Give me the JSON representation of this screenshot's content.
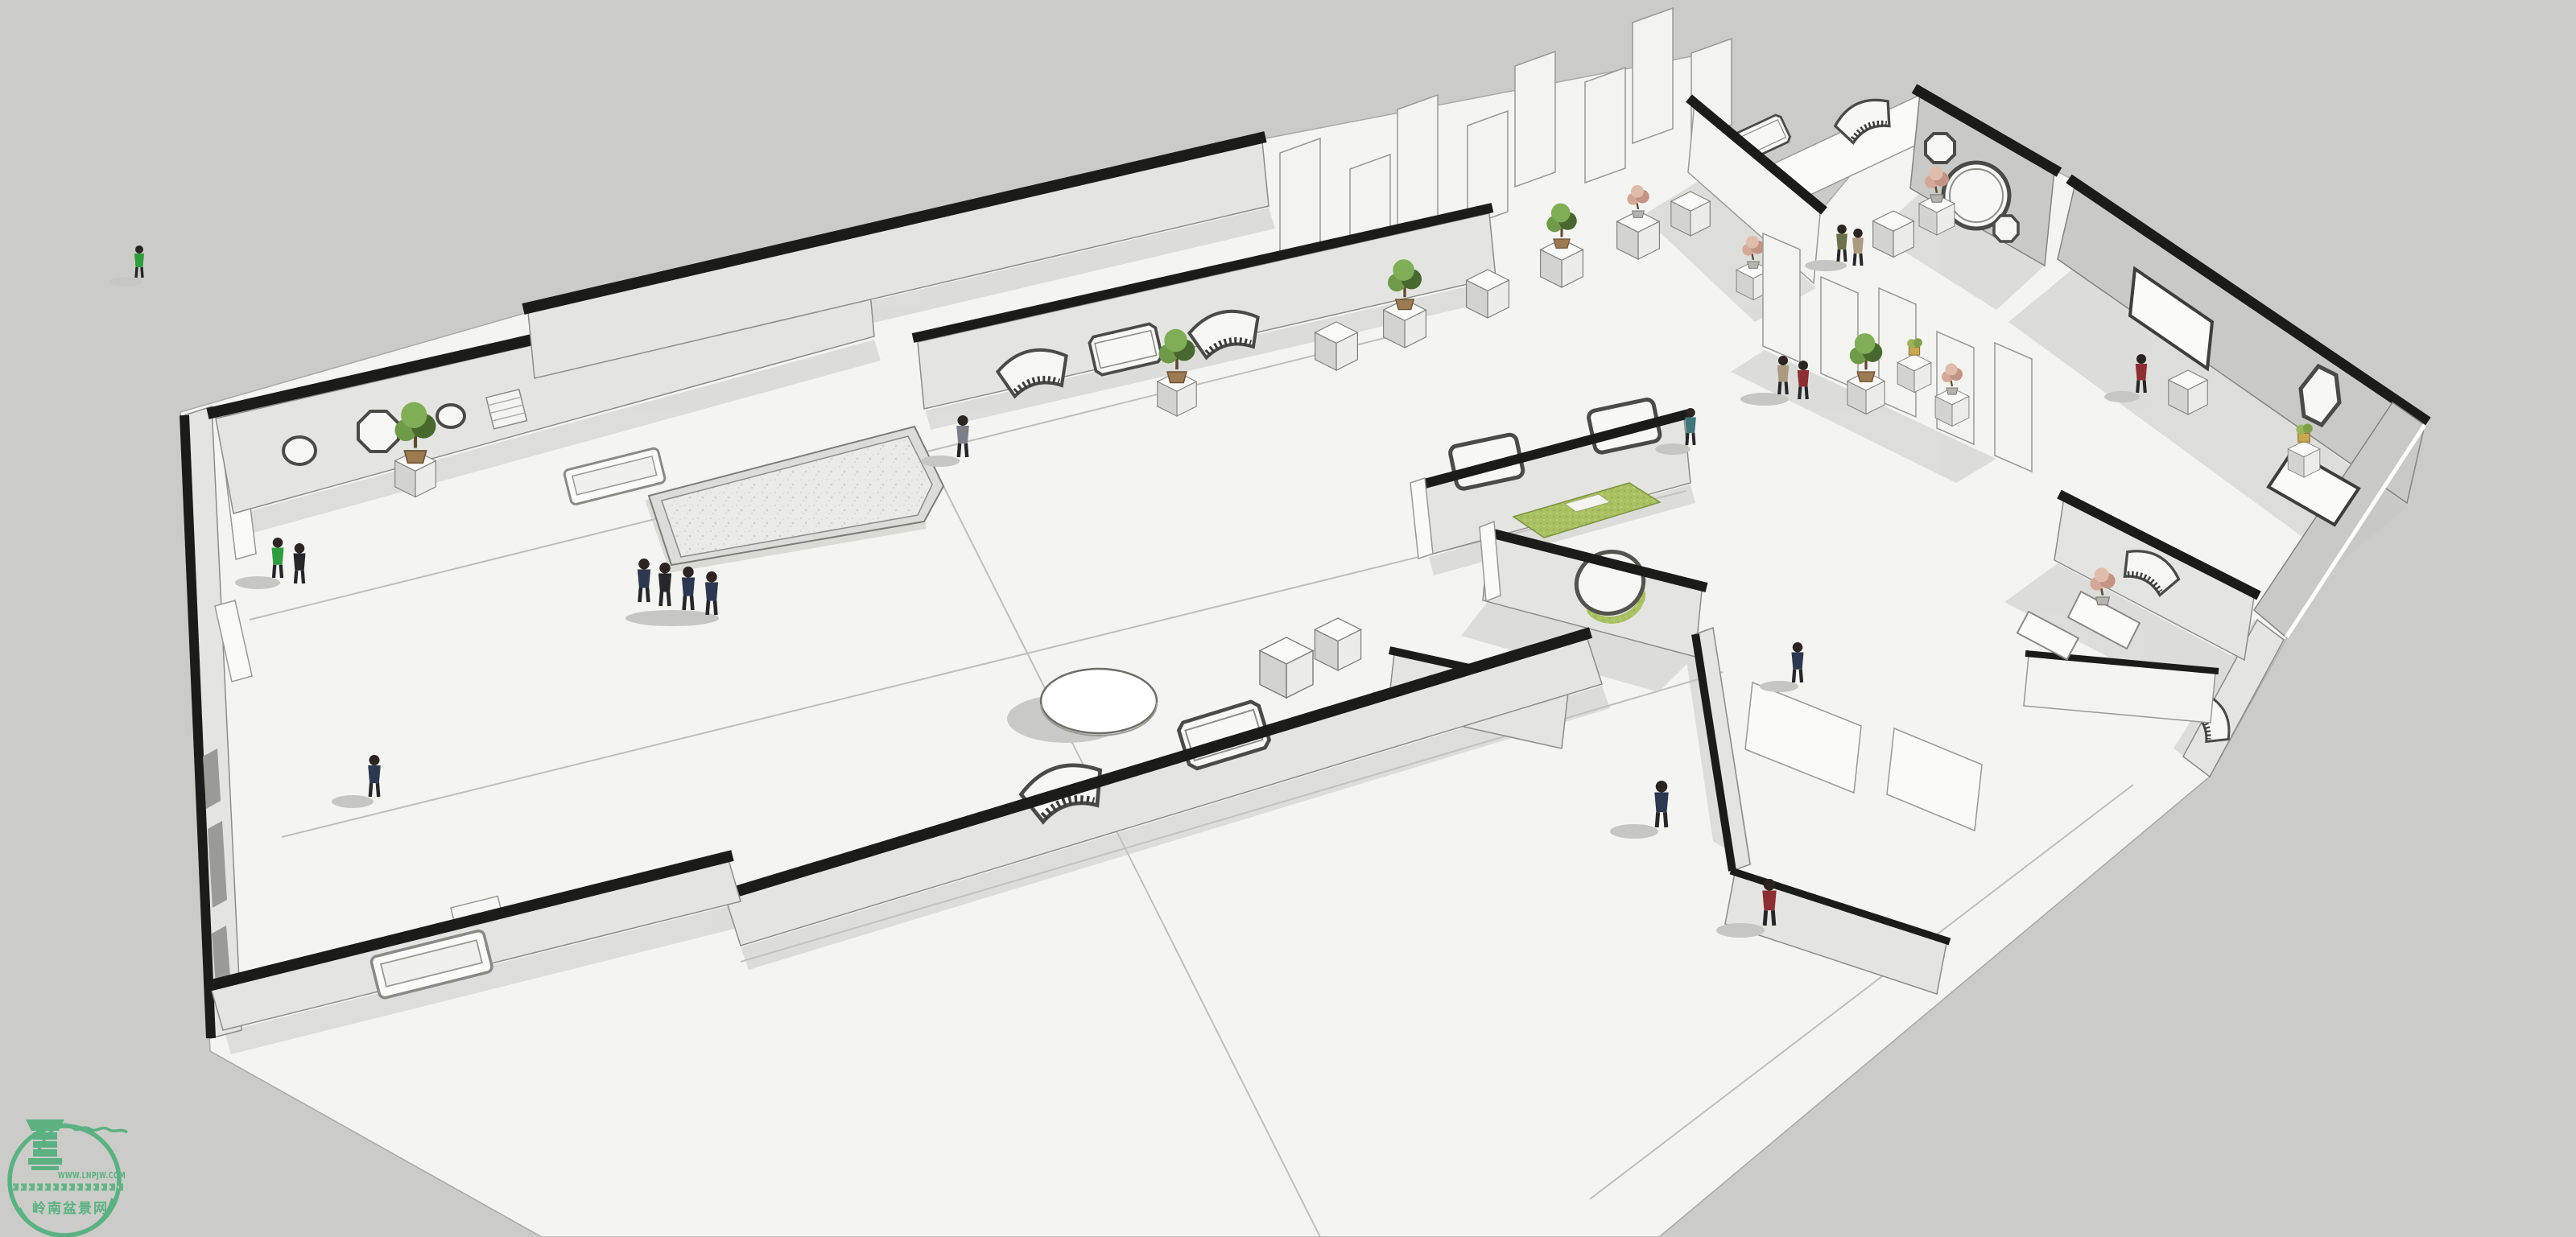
{
  "meta": {
    "type": "3d-architectural-rendering",
    "subject": "Penjing (bonsai) exhibition hall - axonometric SketchUp-style interior view with white black-capped walls, lattice windows, moon gates, display pedestals and visitors"
  },
  "watermark": {
    "site_url": "WWW.LNPJW.COM",
    "site_name_cn": "岭南盆景网",
    "logo_icon": "penjing-pot-logo"
  },
  "palette": {
    "background": "#cbccc7",
    "floor": "#f4f4f1",
    "wall_face": "#e4e4e1",
    "wall_face_shaded": "#c9c9c6",
    "wall_cap": "#1b1b19",
    "edge": "#8a8a85",
    "shadow": "#c6c6c2",
    "glass": "#f7f7f5",
    "mat_green": "#a9c162",
    "plant_green": "#6f9a4a",
    "plant_dark": "#49682f",
    "plant_pink": "#d4a898",
    "pot_brown": "#9c7a52",
    "stage_fill": "#eaeae7",
    "watermark_green": "#5cb183",
    "person_navy": "#2c3850",
    "person_black": "#26262b",
    "person_green": "#2f9c3f",
    "person_gray": "#7b8088",
    "person_tan": "#ab9a7f",
    "person_red": "#8c2f33",
    "person_teal": "#40767c",
    "person_olive": "#6b6f4a"
  },
  "scene": {
    "people_count": 18,
    "bonsai_display_count": 12,
    "display_panel_count": 13,
    "moon_gate_count": 2
  }
}
